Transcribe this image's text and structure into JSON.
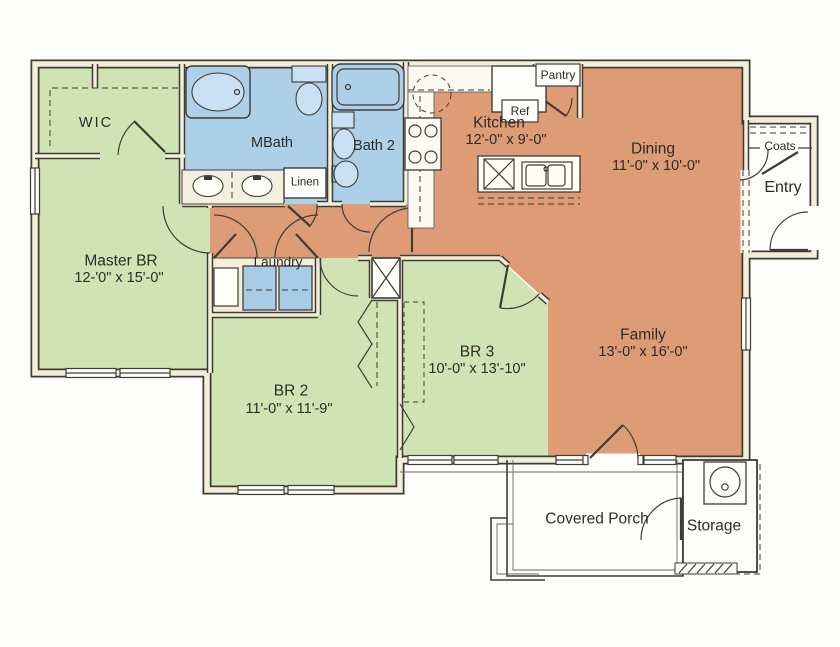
{
  "colors": {
    "bedroom_green": "#cfe3b5",
    "bath_blue": "#aecfe8",
    "living_orange": "#dd9b76",
    "wall_cream": "#f2eeda",
    "line_ink": "#3e3c35"
  },
  "rooms": {
    "wic": {
      "name": "WIC"
    },
    "mbath": {
      "name": "MBath"
    },
    "bath2": {
      "name": "Bath 2"
    },
    "linen": {
      "name": "Linen"
    },
    "kitchen": {
      "name": "Kitchen",
      "dims": "12'-0\" x 9'-0\""
    },
    "ref": {
      "name": "Ref"
    },
    "pantry": {
      "name": "Pantry"
    },
    "dining": {
      "name": "Dining",
      "dims": "11'-0\" x 10'-0\""
    },
    "coats": {
      "name": "Coats"
    },
    "entry": {
      "name": "Entry"
    },
    "master": {
      "name": "Master BR",
      "dims": "12-'0\" x 15'-0\""
    },
    "laundry": {
      "name": "Laundry"
    },
    "br2": {
      "name": "BR 2",
      "dims": "11'-0\" x 11'-9\""
    },
    "br3": {
      "name": "BR 3",
      "dims": "10'-0\" x 13'-10\""
    },
    "family": {
      "name": "Family",
      "dims": "13'-0\" x 16'-0\""
    },
    "porch": {
      "name": "Covered Porch"
    },
    "storage": {
      "name": "Storage"
    }
  }
}
